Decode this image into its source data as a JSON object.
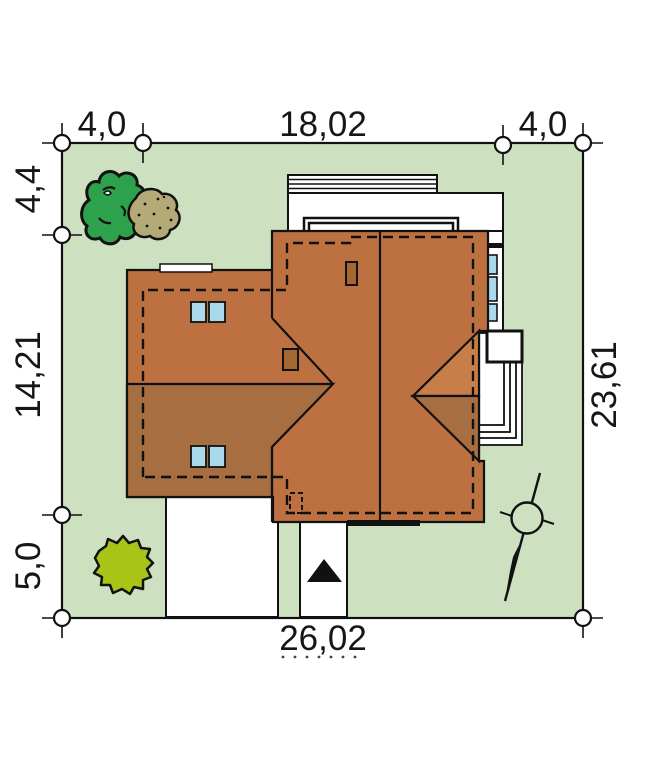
{
  "drawing_title": "house site plan",
  "dimensions": {
    "top_left": "4,0",
    "top_center": "18,02",
    "top_right": "4,0",
    "left_top": "4,4",
    "left_middle": "14,21",
    "left_bottom": "5,0",
    "right_side": "23,61",
    "bottom": "26,02"
  },
  "colors": {
    "plot_green": "#cde1c0",
    "roof_light": "#bd7140",
    "roof_dark": "#a76e42",
    "bay_light": "#c87e48",
    "window_blue": "#aad9ec",
    "chimney_brown": "#a3672f",
    "tree_green": "#2da14b",
    "shrub_olive": "#b3aa78",
    "bush_lime": "#a8c517",
    "outline": "#111111"
  },
  "icons": {
    "north_arrow": "north-arrow",
    "entrance": "entrance-arrow",
    "survey_marker": "survey-point-circle",
    "trees": [
      "deciduous-tree",
      "shrub",
      "bush"
    ]
  }
}
